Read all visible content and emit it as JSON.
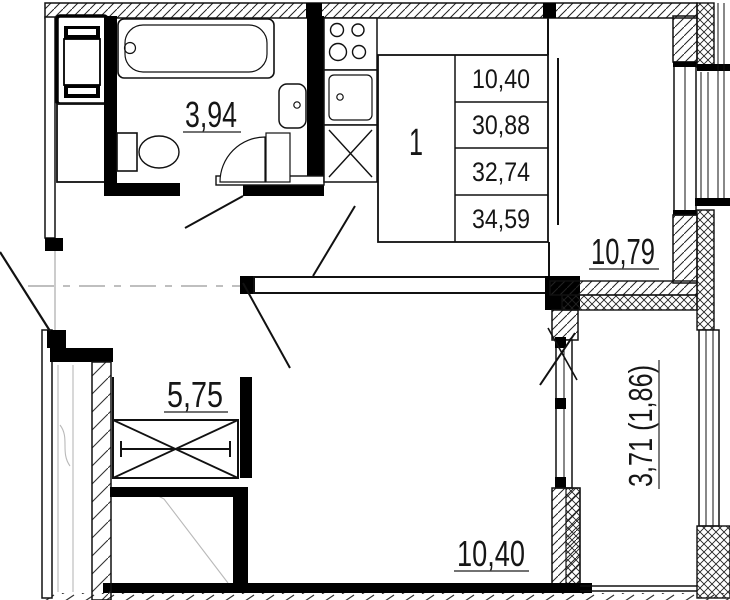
{
  "unit_table": {
    "rooms_count": "1",
    "areas": [
      "10,40",
      "30,88",
      "32,74",
      "34,59"
    ]
  },
  "room_labels": {
    "bathroom": "3,94",
    "kitchen_living": "10,79",
    "hall": "5,75",
    "living_room": "10,40",
    "balcony": "3,71 (1,86)"
  },
  "colors": {
    "line": "#111111",
    "ghost": "#b9b9b9",
    "centerline": "#999999",
    "background": "#ffffff"
  }
}
